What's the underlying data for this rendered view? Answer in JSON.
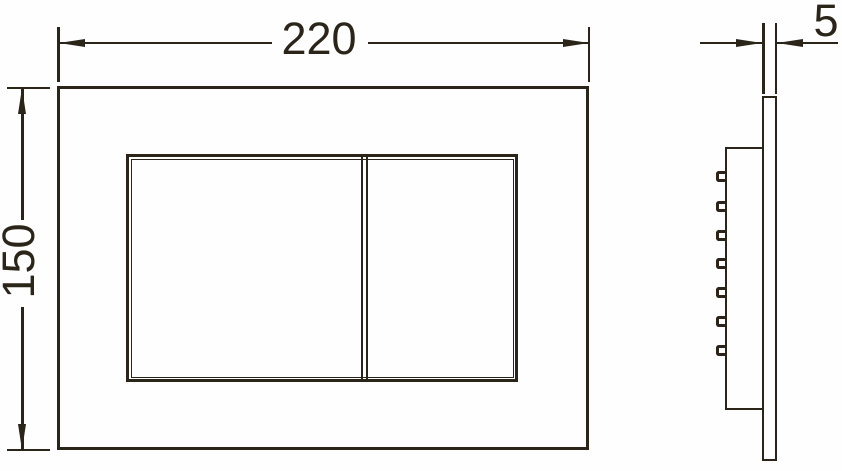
{
  "drawing": {
    "background_color": "#fefefe",
    "line_color": "#2b2418",
    "dimensions": {
      "width": {
        "value": "220"
      },
      "height": {
        "value": "150"
      },
      "thickness": {
        "value": "5"
      }
    },
    "side_view": {
      "mounting_clip_count": 7
    }
  }
}
